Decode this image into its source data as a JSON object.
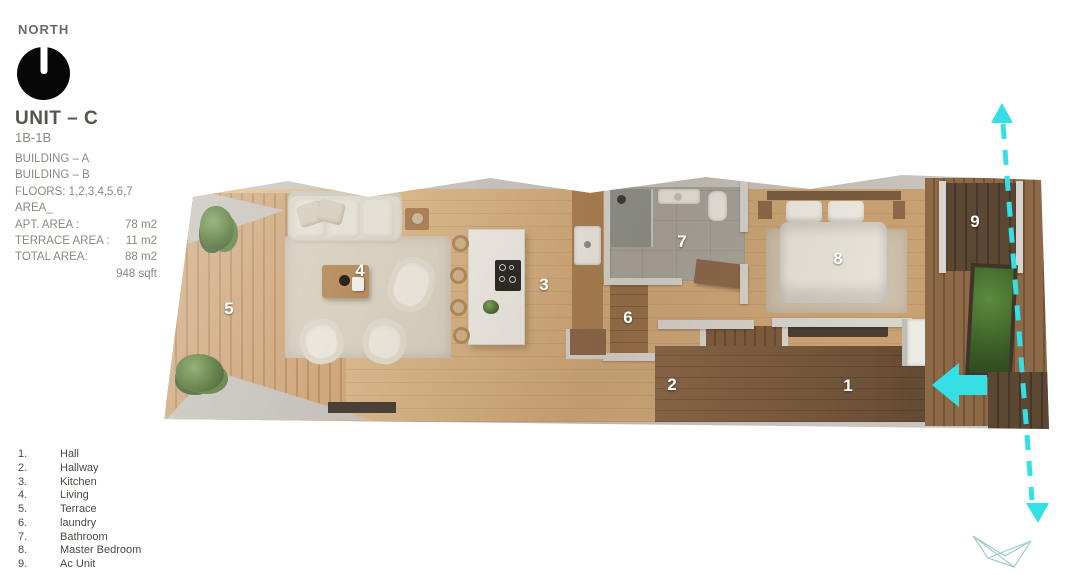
{
  "compass": {
    "label": "NORTH"
  },
  "unit": {
    "title": "UNIT – C",
    "type": "1B-1B",
    "details": [
      "BUILDING – A",
      "BUILDING – B",
      "FLOORS: 1,2,3,4,5,6,7",
      "AREA_"
    ],
    "areas": [
      {
        "label": "APT. AREA :",
        "value": "78 m2"
      },
      {
        "label": "TERRACE AREA :",
        "value": "11 m2"
      },
      {
        "label": "TOTAL AREA:",
        "value": "88 m2"
      },
      {
        "label": "",
        "value": "948 sqft"
      }
    ]
  },
  "legend": {
    "items": [
      {
        "num": "1.",
        "label": "Hall"
      },
      {
        "num": "2.",
        "label": "Hallway"
      },
      {
        "num": "3.",
        "label": "Kitchen"
      },
      {
        "num": "4.",
        "label": "Living"
      },
      {
        "num": "5.",
        "label": "Terrace"
      },
      {
        "num": "6.",
        "label": "laundry"
      },
      {
        "num": "7.",
        "label": "Bathroom"
      },
      {
        "num": "8.",
        "label": "Master Bedroom"
      },
      {
        "num": "9.",
        "label": "Ac Unit"
      }
    ]
  },
  "plan": {
    "rooms": [
      {
        "number": "1",
        "name": "Hall"
      },
      {
        "number": "2",
        "name": "Hallway"
      },
      {
        "number": "3",
        "name": "Kitchen"
      },
      {
        "number": "4",
        "name": "Living"
      },
      {
        "number": "5",
        "name": "Terrace"
      },
      {
        "number": "6",
        "name": "laundry"
      },
      {
        "number": "7",
        "name": "Bathroom"
      },
      {
        "number": "8",
        "name": "Master Bedroom"
      },
      {
        "number": "9",
        "name": "Ac Unit"
      }
    ]
  },
  "colors": {
    "accent": "#35dfe6",
    "logo_stroke": "#a3cbce"
  }
}
